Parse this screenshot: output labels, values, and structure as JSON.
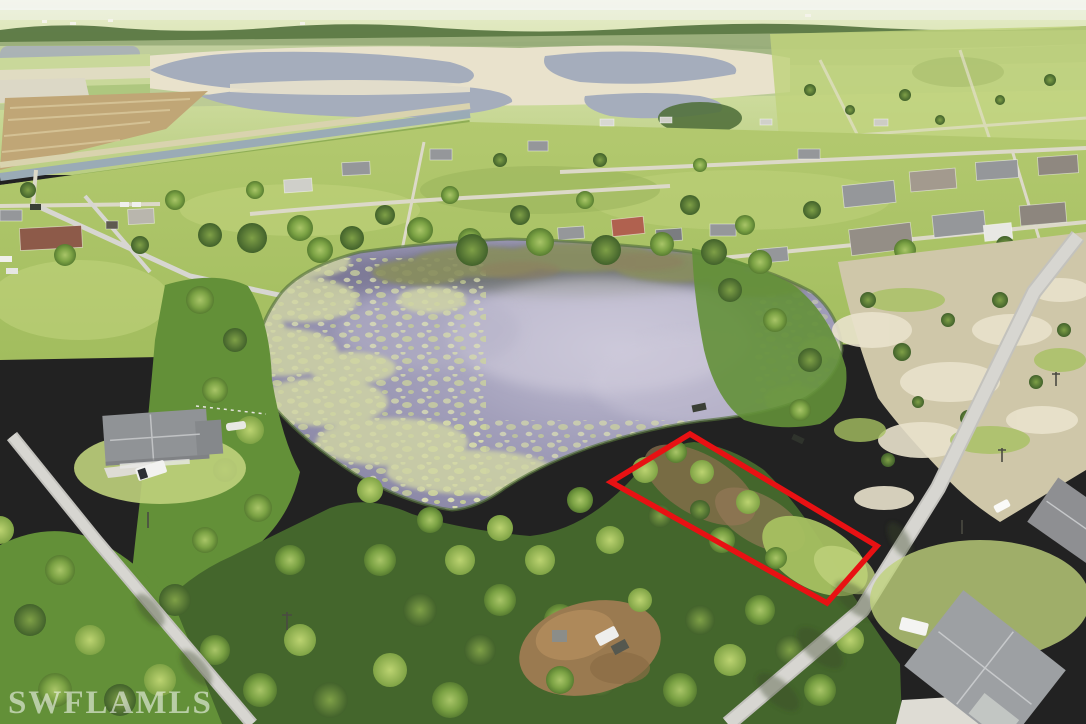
{
  "watermark": {
    "text": "SWFLAMLS"
  },
  "colors": {
    "boundary_red": "#e81113",
    "pond_water": "#8f8cab",
    "pond_light": "#c3c0d4",
    "pond_dark": "#6e6c88",
    "lily_olive": "#8a8f60",
    "algae": "#d2d7a4",
    "canal_water": "#9aabb6",
    "distant_water": "#a5adbc",
    "sand_flat": "#e9e2cc",
    "sand_scrub": "#cfc7a9",
    "field_brown": "#c0a676",
    "distant_field": "#d9e3ab",
    "distant_treeline": "#52713c",
    "grass": "#a6c061",
    "grass_light": "#bfd27c",
    "forest_dark": "#44662c",
    "forest_mid": "#639038",
    "canopy_light": "#8ab052",
    "road": "#d7d6d1",
    "concrete": "#dedcd4",
    "roof_grey": "#95979a",
    "roof_dark": "#7b7d80",
    "roof_brown": "#8d5a49",
    "roof_terracotta": "#b0614f",
    "haze_white": "#f4f6f2",
    "watermark": "rgba(255,255,255,0.55)"
  }
}
